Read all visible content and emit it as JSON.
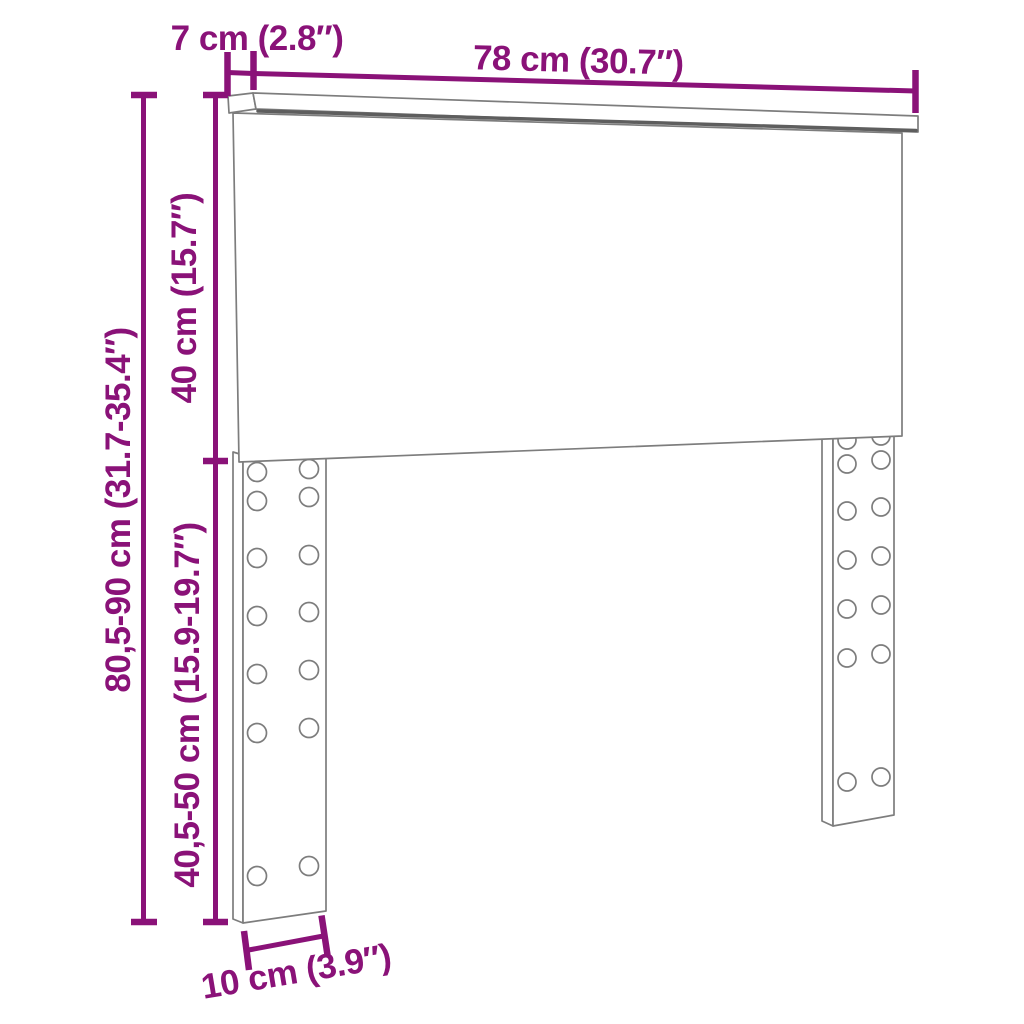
{
  "colors": {
    "accent": "#8A1278",
    "outline": "#7d7d7d",
    "outline_dark": "#5e5e5e",
    "background": "#ffffff"
  },
  "labels": {
    "cap_depth": "7 cm (2.8″)",
    "total_width": "78 cm (30.7″)",
    "upper_height": "40 cm (15.7″)",
    "total_height": "80,5-90 cm (31.7-35.4″)",
    "leg_height": "40,5-50 cm (15.9-19.7″)",
    "leg_width": "10 cm (3.9″)"
  }
}
